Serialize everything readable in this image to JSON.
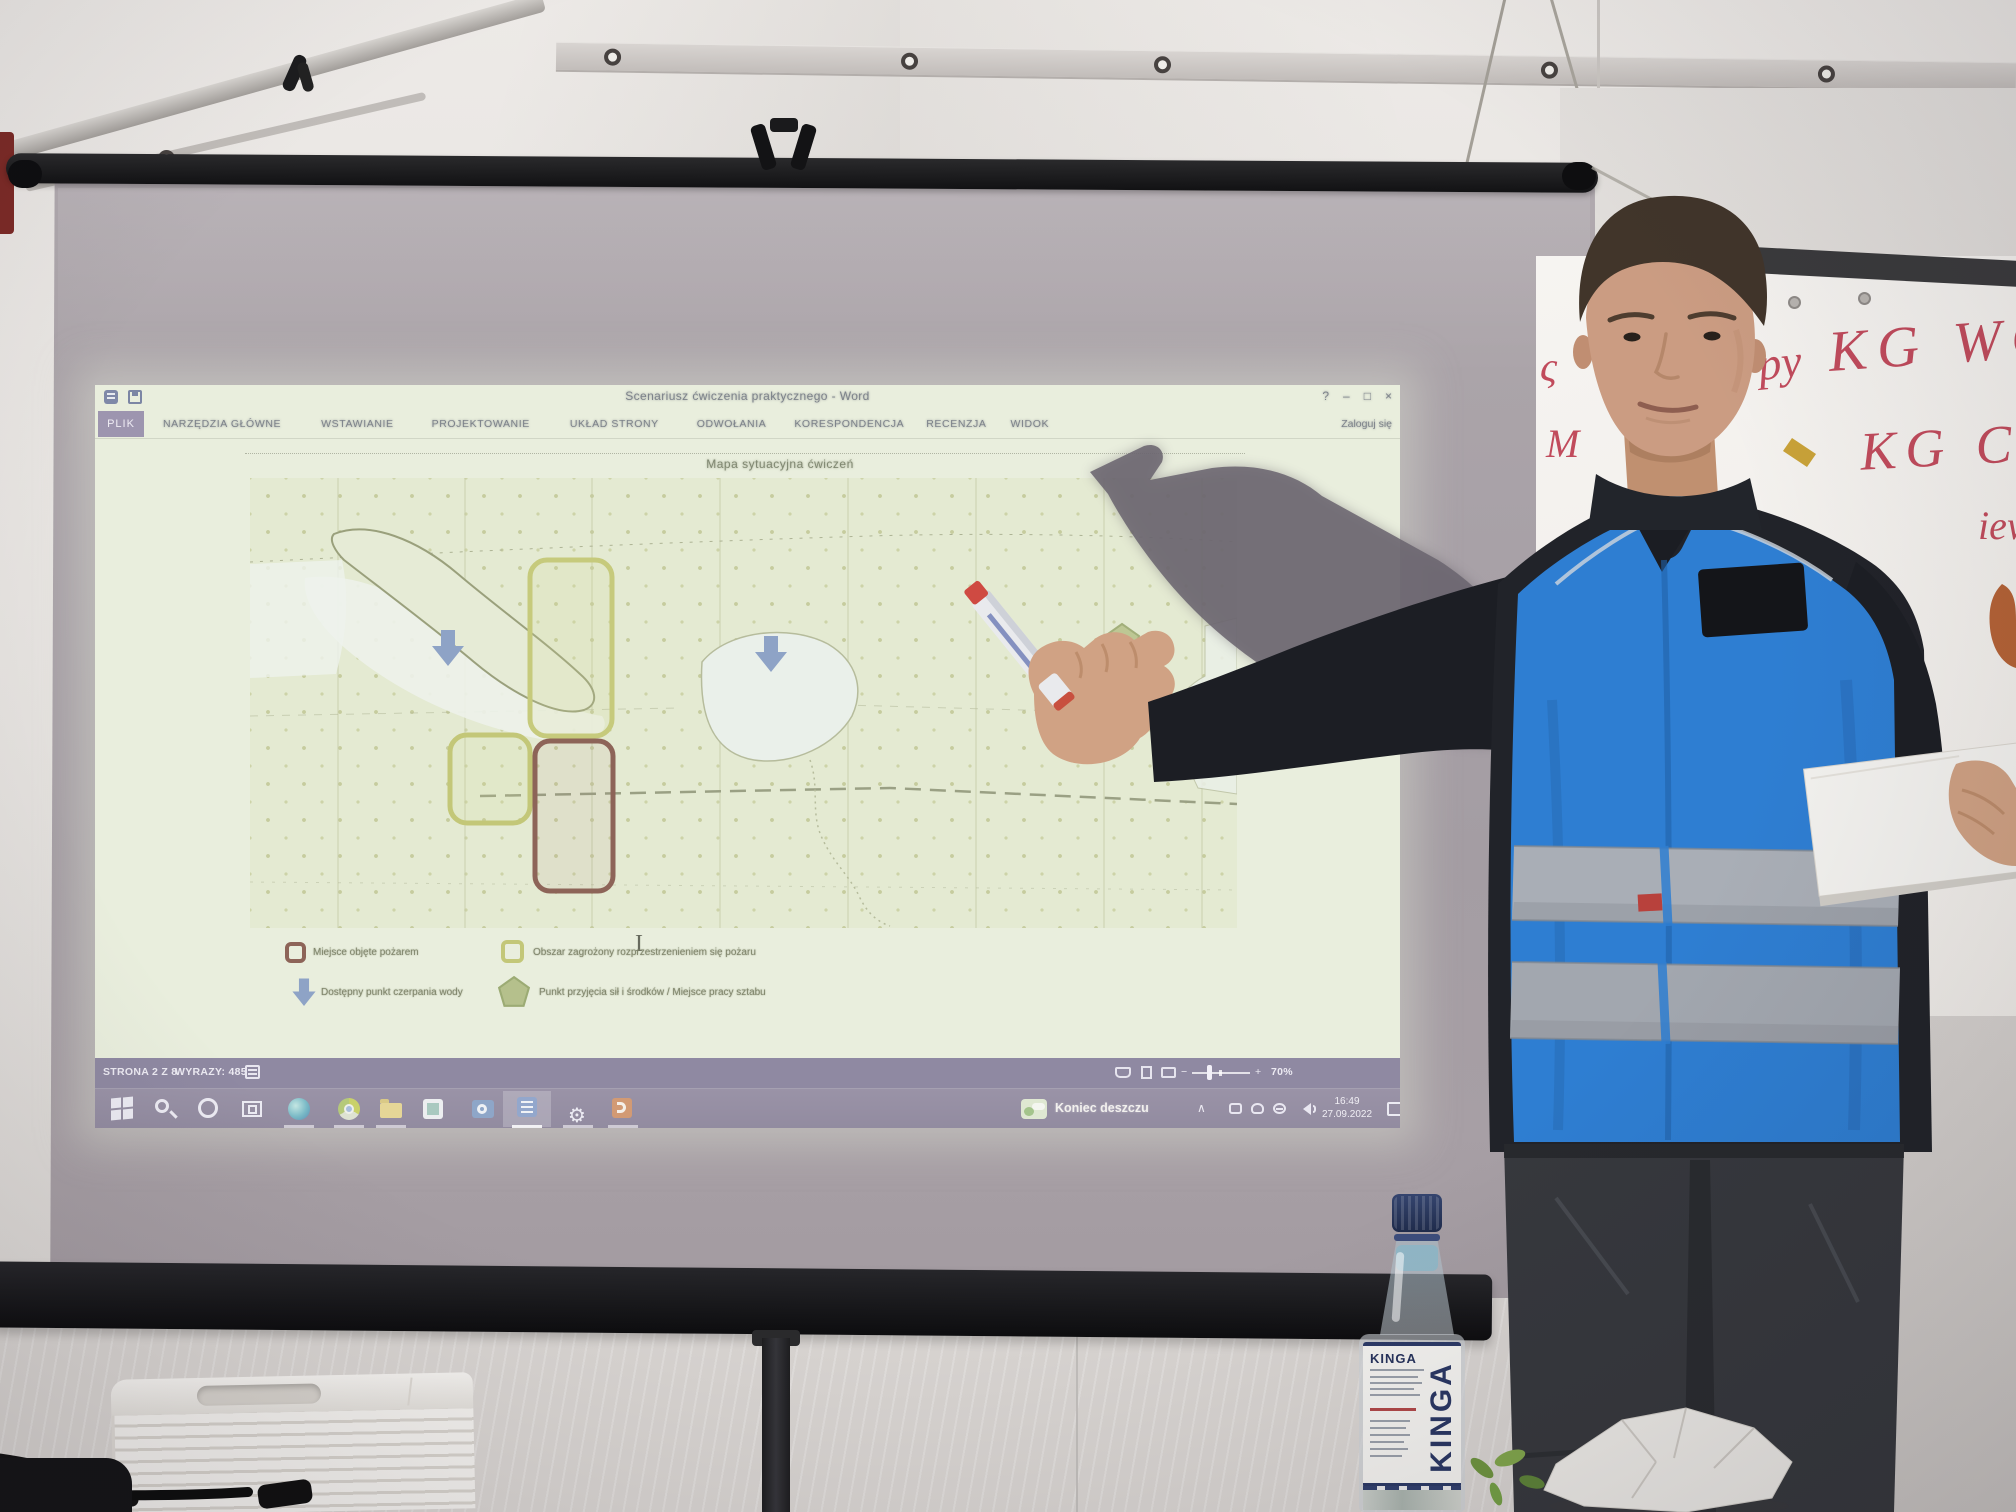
{
  "window": {
    "title": "Scenariusz ćwiczenia praktycznego - Word",
    "sign_in": "Zaloguj się",
    "controls": {
      "help": "?",
      "minimize": "–",
      "restore": "□",
      "close": "×"
    },
    "quick_access": [
      "word-logo",
      "save"
    ]
  },
  "ribbon": {
    "tabs": [
      {
        "label": "PLIK",
        "active": true
      },
      {
        "label": "NARZĘDZIA GŁÓWNE"
      },
      {
        "label": "WSTAWIANIE"
      },
      {
        "label": "PROJEKTOWANIE"
      },
      {
        "label": "UKŁAD STRONY"
      },
      {
        "label": "ODWOŁANIA"
      },
      {
        "label": "KORESPONDENCJA"
      },
      {
        "label": "RECENZJA"
      },
      {
        "label": "WIDOK"
      }
    ]
  },
  "document": {
    "map_title": "Mapa sytuacyjna ćwiczeń",
    "cursor": "I",
    "legend": [
      {
        "symbol": "red-outline-square",
        "label": "Miejsce objęte pożarem"
      },
      {
        "symbol": "yellow-outline-square",
        "label": "Obszar zagrożony rozprzestrzenieniem się pożaru"
      },
      {
        "symbol": "blue-down-arrow",
        "label": "Dostępny punkt czerpania wody"
      },
      {
        "symbol": "green-pentagon",
        "label": "Punkt przyjęcia sił i środków / Miejsce pracy sztabu"
      }
    ]
  },
  "status_bar": {
    "page": "STRONA 2 Z 8",
    "words": "WYRAZY: 485",
    "view_icons": [
      "read-mode",
      "print-layout",
      "web-layout"
    ],
    "zoom_minus": "−",
    "zoom_plus": "+",
    "zoom_level": "70%"
  },
  "taskbar": {
    "weather": "Koniec deszczu",
    "tray_chevron": "∧",
    "time": "16:49",
    "date": "27.09.2022",
    "icons": [
      {
        "name": "start"
      },
      {
        "name": "search"
      },
      {
        "name": "cortana"
      },
      {
        "name": "task-view"
      },
      {
        "name": "edge",
        "running": true
      },
      {
        "name": "chrome",
        "running": true
      },
      {
        "name": "file-explorer",
        "running": true
      },
      {
        "name": "photos"
      },
      {
        "name": "outlook"
      },
      {
        "name": "word",
        "running": true,
        "active": true
      },
      {
        "name": "settings",
        "running": true,
        "glyph": "⚙"
      },
      {
        "name": "powerpoint",
        "running": true
      }
    ]
  },
  "whiteboard": {
    "writing_color": "#c14b5c",
    "fragments": {
      "a": "ς",
      "b": "M",
      "line1_lead": "py",
      "line1": "KG WOO",
      "line2": "KG COO",
      "line3": "iew"
    }
  },
  "bottle": {
    "brand": "KINGA",
    "brand_vertical": "KINGA"
  },
  "colors": {
    "vest_blue": "#2e7ed2",
    "reflective_band": "#a9aeb6",
    "projection_tint": "#e9eedd",
    "plik_tab": "#9d95af",
    "status_bar": "#8f89a2",
    "taskbar": "#9790a4",
    "map_zone_warning_yellow": "#c6ca7c",
    "map_zone_fire_red": "#8d6458",
    "map_arrow_blue": "#8ea3c6",
    "map_pentagon_green": "#b5c08c",
    "bottle_cap_navy": "#2b3a60",
    "marker_red": "#c14b5c"
  }
}
